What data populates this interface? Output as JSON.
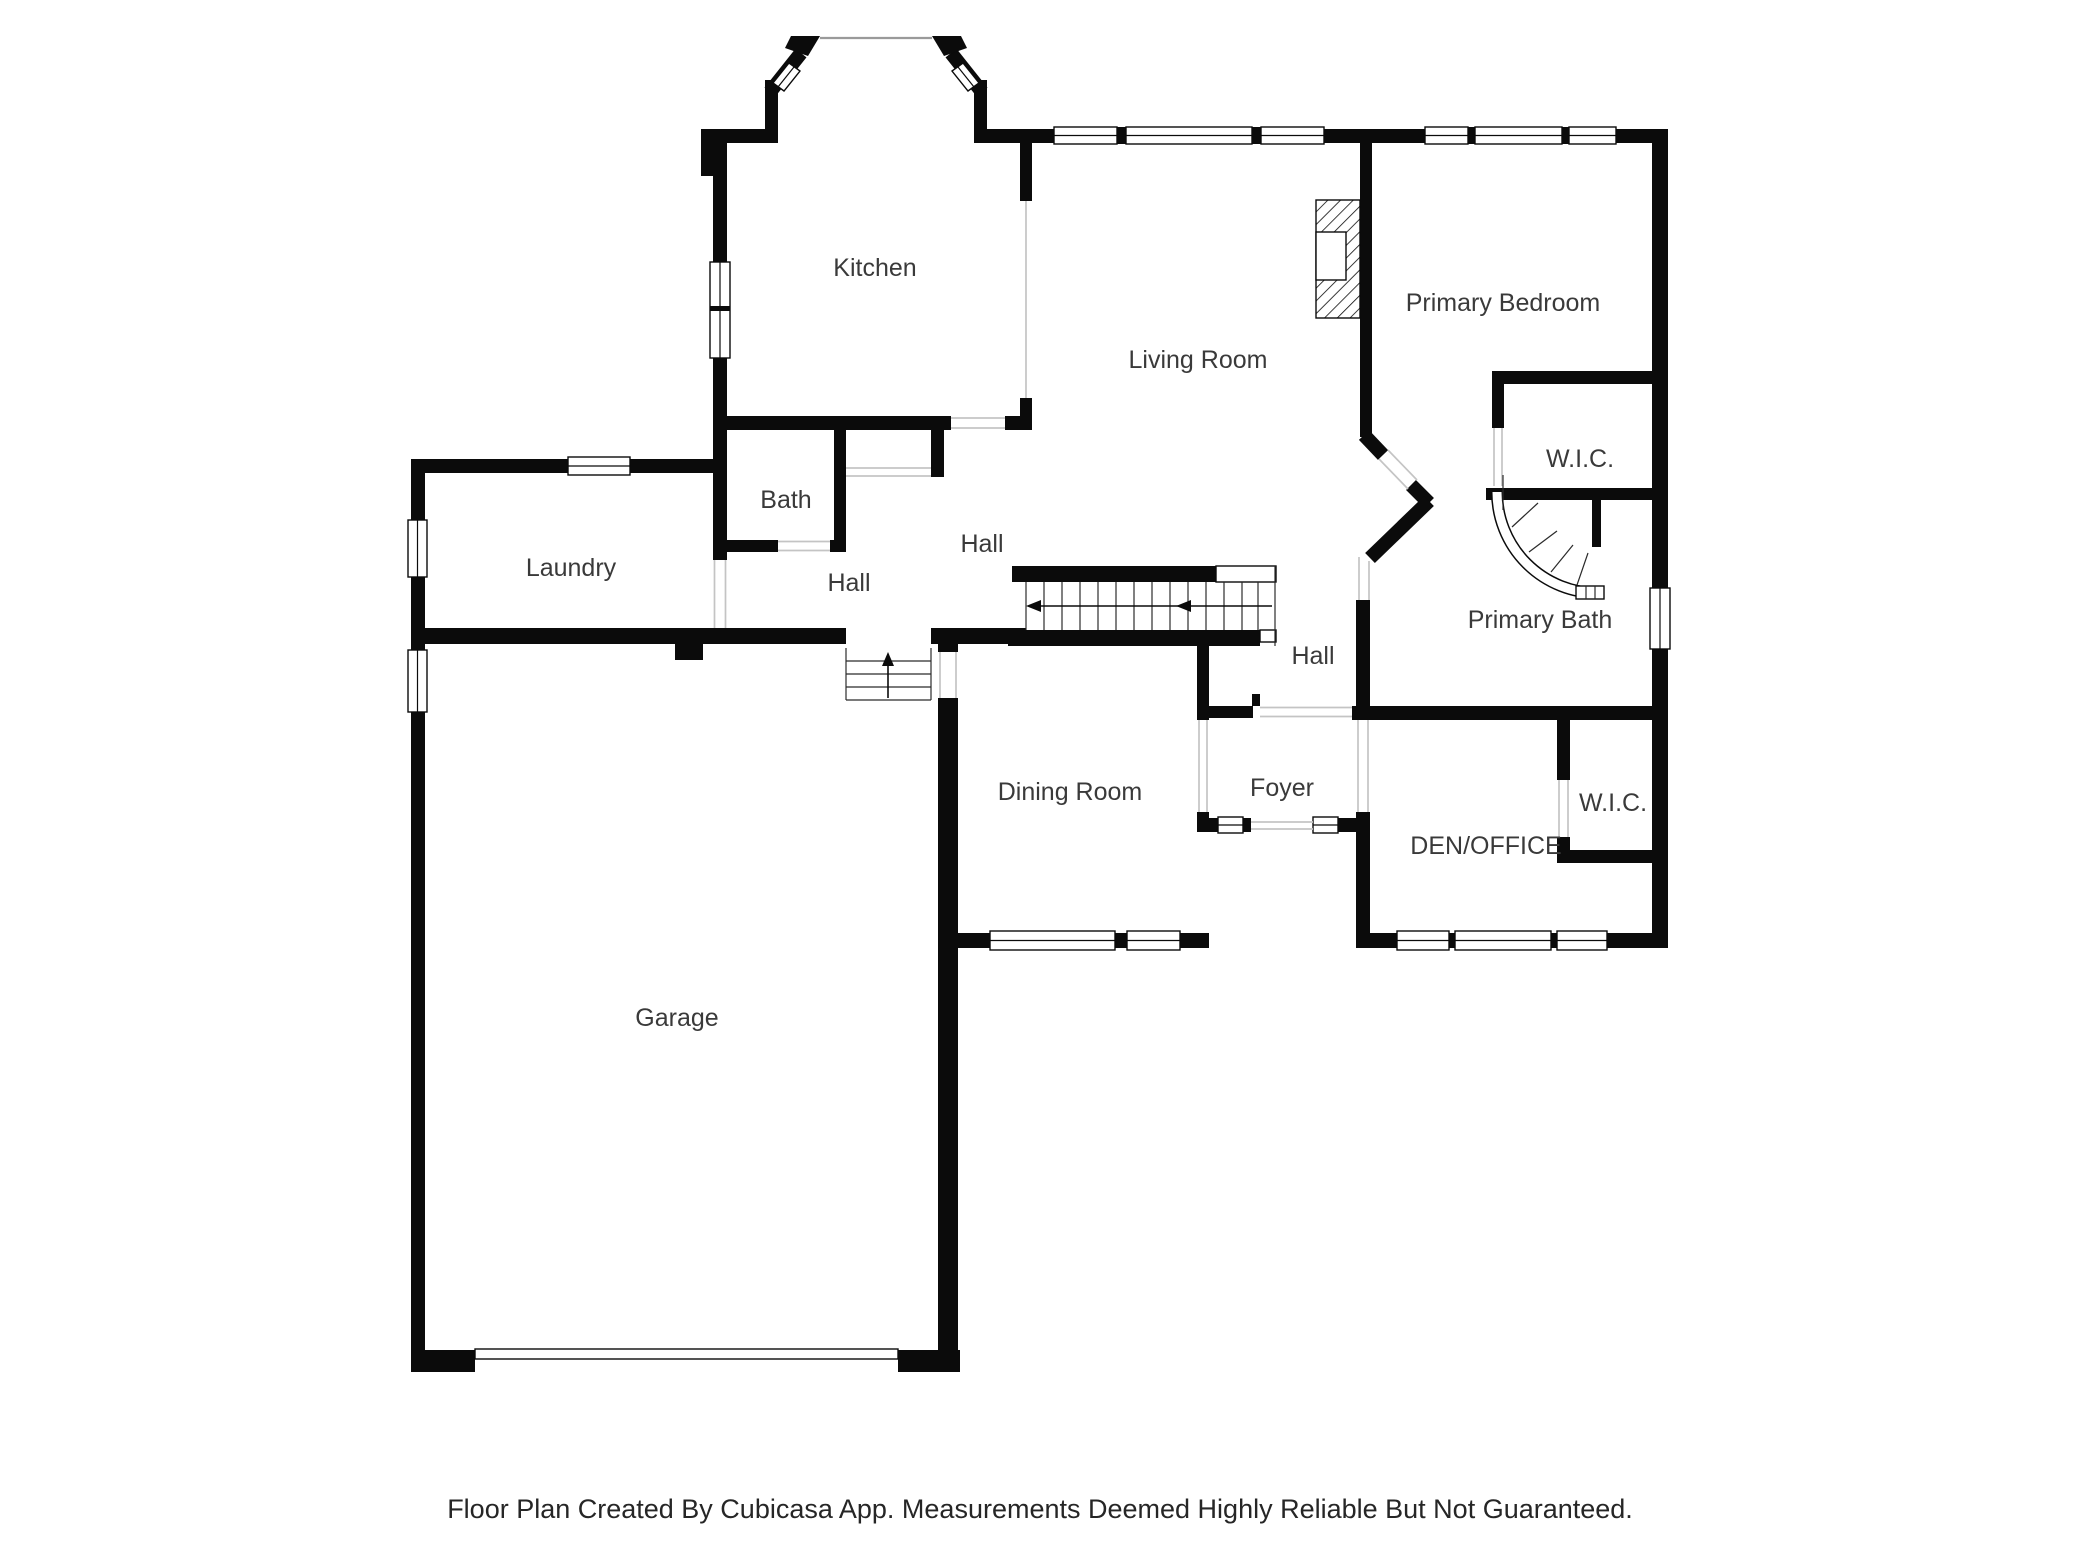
{
  "floor_plan": {
    "labels": [
      {
        "id": "kitchen",
        "text": "Kitchen",
        "x": 875,
        "y": 276
      },
      {
        "id": "living-room",
        "text": "Living Room",
        "x": 1198,
        "y": 368
      },
      {
        "id": "primary-bedroom",
        "text": "Primary Bedroom",
        "x": 1503,
        "y": 311
      },
      {
        "id": "wic-upper",
        "text": "W.I.C.",
        "x": 1580,
        "y": 467
      },
      {
        "id": "primary-bath",
        "text": "Primary Bath",
        "x": 1540,
        "y": 628
      },
      {
        "id": "bath",
        "text": "Bath",
        "x": 786,
        "y": 508
      },
      {
        "id": "hall-upper",
        "text": "Hall",
        "x": 982,
        "y": 552
      },
      {
        "id": "hall-left",
        "text": "Hall",
        "x": 849,
        "y": 591
      },
      {
        "id": "hall-lower",
        "text": "Hall",
        "x": 1313,
        "y": 664
      },
      {
        "id": "laundry",
        "text": "Laundry",
        "x": 571,
        "y": 576
      },
      {
        "id": "dining-room",
        "text": "Dining Room",
        "x": 1070,
        "y": 800
      },
      {
        "id": "foyer",
        "text": "Foyer",
        "x": 1282,
        "y": 796
      },
      {
        "id": "den-office",
        "text": "DEN/OFFICE",
        "x": 1486,
        "y": 854
      },
      {
        "id": "wic-lower",
        "text": "W.I.C.",
        "x": 1613,
        "y": 811
      },
      {
        "id": "garage",
        "text": "Garage",
        "x": 677,
        "y": 1026
      }
    ],
    "footer": "Floor Plan Created By Cubicasa App. Measurements Deemed Highly Reliable But Not Guaranteed.",
    "colors": {
      "wall": "#0b0b0b",
      "label": "#3a3a3a",
      "opening": "#c4c4c4",
      "background": "#ffffff"
    }
  }
}
